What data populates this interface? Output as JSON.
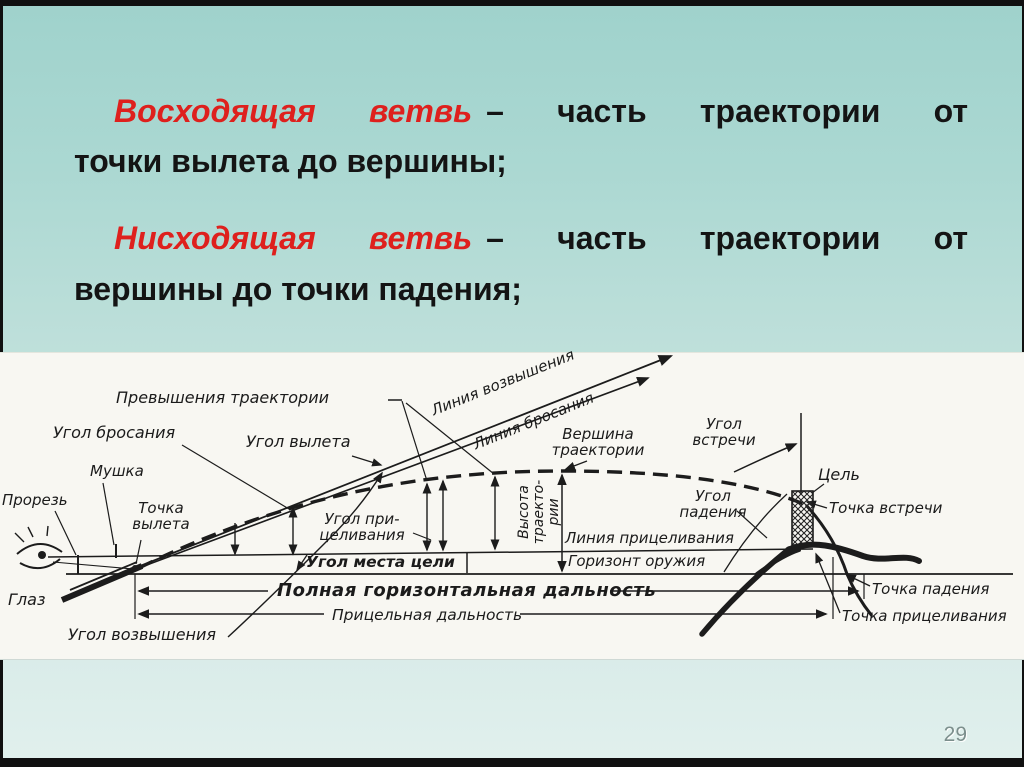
{
  "slide": {
    "page_number": "29",
    "term_color": "#de201d",
    "definitions": [
      {
        "term": "Восходящая ветвь",
        "rest_line1": "– часть траектории от",
        "line2": "точки вылета до вершины;"
      },
      {
        "term": "Нисходящая ветвь",
        "rest_line1": "– часть траектории от",
        "line2": "вершины до точки падения;"
      }
    ]
  },
  "diagram": {
    "labels": {
      "prevyshenie": "Превышения траектории",
      "ugol_brosaniya": "Угол бросания",
      "ugol_vyleta": "Угол вылета",
      "mushka": "Мушка",
      "prorez": "Прорезь",
      "tochka_vyleta_1": "Точка",
      "tochka_vyleta_2": "вылета",
      "glaz": "Глаз",
      "ugol_vozvysheniya": "Угол возвышения",
      "liniya_vozvysheniya": "Линия возвышения",
      "liniya_brosaniya": "Линия бросания",
      "vershina_1": "Вершина",
      "vershina_2": "траектории",
      "ugol_pritselivaniya_1": "Угол при-",
      "ugol_pritselivaniya_2": "целивания",
      "ugol_mesta_tseli": "Угол места цели",
      "vysota_1": "Высота",
      "vysota_2": "траекто-",
      "vysota_3": "рии",
      "liniya_pritselivaniya": "Линия прицеливания",
      "gorizont_oruzhiya": "Горизонт оружия",
      "polnaya_dalnost": "Полная горизонтальная дальность",
      "pritselnaya_dalnost": "Прицельная дальность",
      "ugol_vstrechi_1": "Угол",
      "ugol_vstrechi_2": "встречи",
      "ugol_padeniya_1": "Угол",
      "ugol_padeniya_2": "падения",
      "tsel": "Цель",
      "tochka_vstrechi": "Точка встречи",
      "tochka_padeniya": "Точка падения",
      "tochka_pritselivaniya": "Точка прицеливания"
    }
  }
}
